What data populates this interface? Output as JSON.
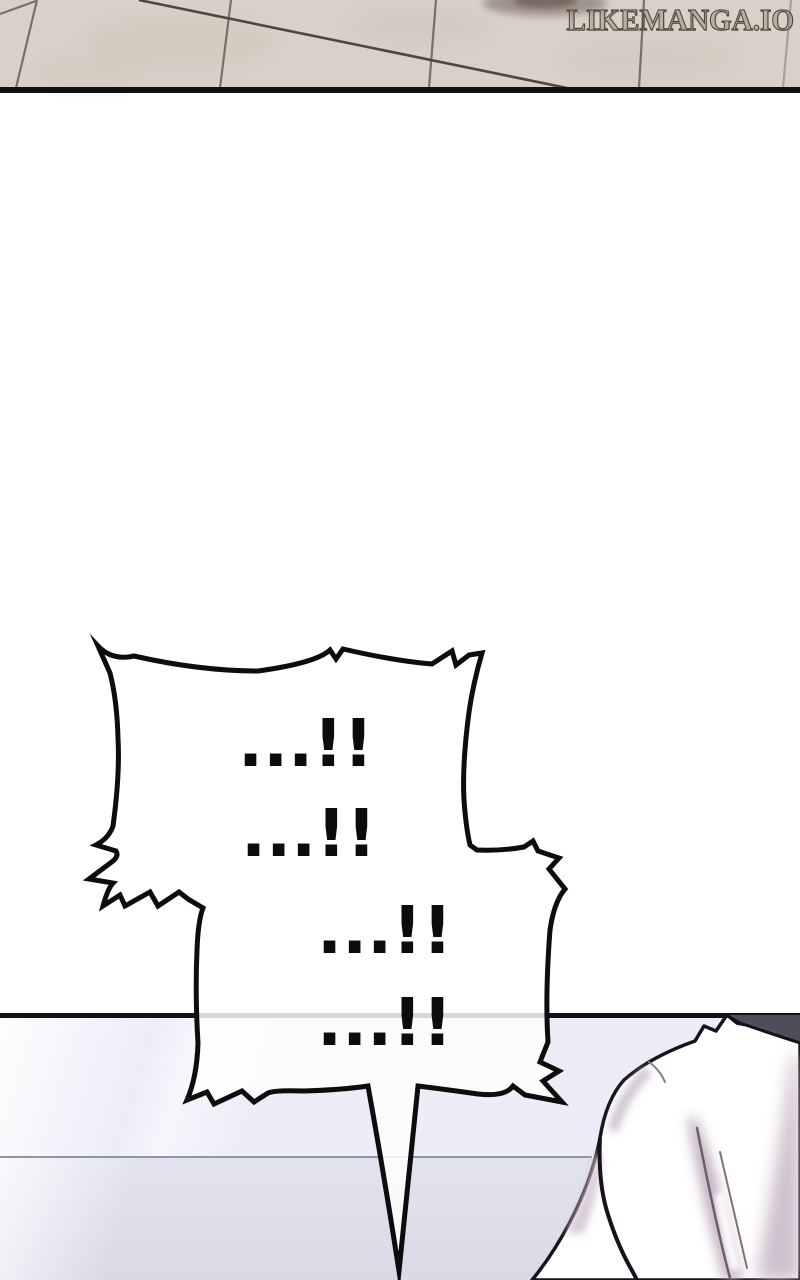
{
  "watermark": {
    "text": "LikeManga.Io"
  },
  "speech_bubble": {
    "lines": [
      "...!!",
      "...!!",
      "...!!",
      "...!!"
    ]
  },
  "colors": {
    "tile_floor": "#d9d0c7",
    "tile_grout": "#6e655d",
    "panel_border_black": "#131110",
    "background_white": "#ffffff",
    "floor_light_lavender": "#ecedf7",
    "floor_shadow_lavender": "#d9dae6",
    "bubble_outline": "#0d0d0d",
    "bubble_fill": "#ffffff",
    "hair_dark": "#514c59",
    "cloth_shading_pink": "#b39fb1"
  }
}
